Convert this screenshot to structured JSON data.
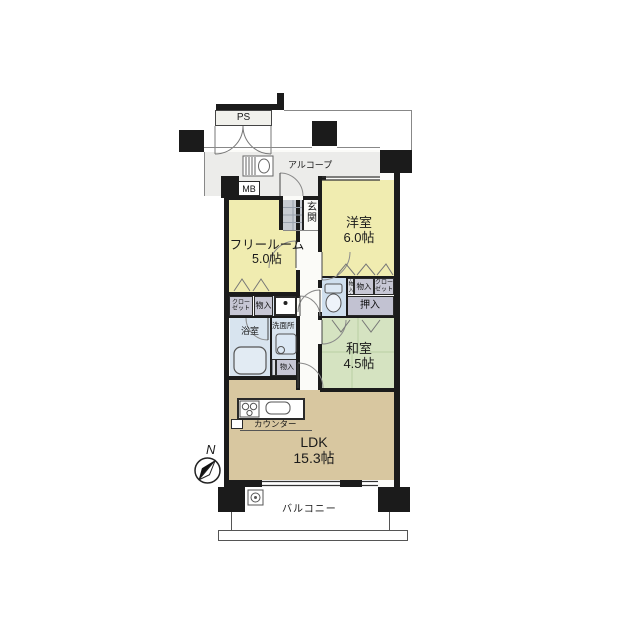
{
  "exterior": {
    "ps_label": "PS",
    "alcove_label": "アルコープ",
    "meter_box_label": "MB",
    "balcony_label": "バルコニー",
    "compass_label": "N"
  },
  "rooms": {
    "entrance_label": "玄関",
    "western_room": {
      "name": "洋室",
      "size": "6.0帖"
    },
    "free_room": {
      "name": "フリールーム",
      "size": "5.0帖"
    },
    "japanese_room": {
      "name": "和室",
      "size": "4.5帖"
    },
    "ldk": {
      "name": "LDK",
      "size": "15.3帖"
    },
    "bathroom_label": "浴室",
    "washroom_label": "洗面所",
    "kitchen_counter_label": "カウンター"
  },
  "storage": {
    "closet_line1": "クロー",
    "closet_line2": "ゼット",
    "monoire_label": "物入",
    "monoire_vertical": "物入",
    "oshiire_label": "押入"
  },
  "colors": {
    "wall": "#1b1b1b",
    "room_yellow": "#f0ecb0",
    "room_green": "#d5e3c1",
    "room_tan": "#d8c7a0",
    "wet_blue": "#d8e4ef",
    "toilet_blue": "#cfdfee",
    "closet_gray": "#c7c7d5",
    "entrance_tile": "#c8ccd3",
    "alcove_gray": "#ececea"
  }
}
